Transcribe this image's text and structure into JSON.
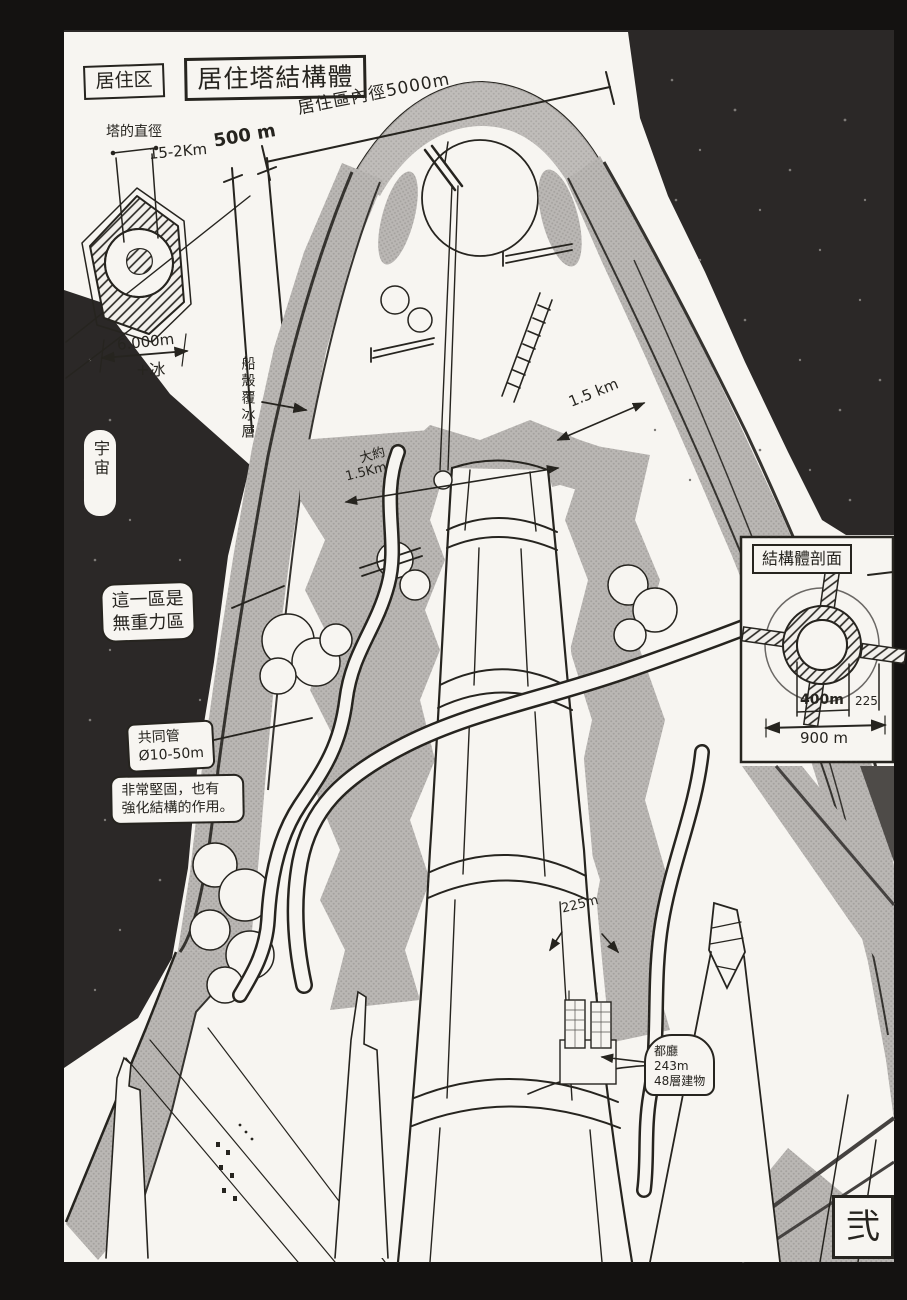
{
  "colors": {
    "space_bg": "#2b2827",
    "frame": "#141211",
    "paper": "#f7f5f1",
    "ink": "#26241f",
    "halftone_gray": "#b9b6b3"
  },
  "header": {
    "area_tag": "居住区",
    "title": "居住塔結構體"
  },
  "hex_inset": {
    "caption": "塔的直徑",
    "diameter": "15-2Km",
    "width": "6.000m",
    "plus_ice": "+冰"
  },
  "top_dims": {
    "wall_thickness": "500 m",
    "inner_diameter": "居住區內徑5000m"
  },
  "side_labels": {
    "hull_ice": "船殼覆冰層",
    "space": "宇宙"
  },
  "mid_dims": {
    "approx": "大約",
    "approx_value": "1.5Km",
    "right_span": "1.5 km",
    "column_width": "225m"
  },
  "callouts": {
    "zero_g": {
      "line1": "這一區是",
      "line2": "無重力區"
    },
    "pipe": {
      "line1": "共同管",
      "line2": "Ø10-50m"
    },
    "sturdy": {
      "line1": "非常堅固，也有",
      "line2": "強化結構的作用。"
    },
    "tocho": {
      "line1": "都廳",
      "line2": "243m",
      "line3": "48層建物"
    }
  },
  "cross_section": {
    "title": "結構體剖面",
    "dim_inner": "400m",
    "dim_wall": "225",
    "dim_outer": "900 m"
  },
  "page": {
    "number_stamp": "弐"
  }
}
